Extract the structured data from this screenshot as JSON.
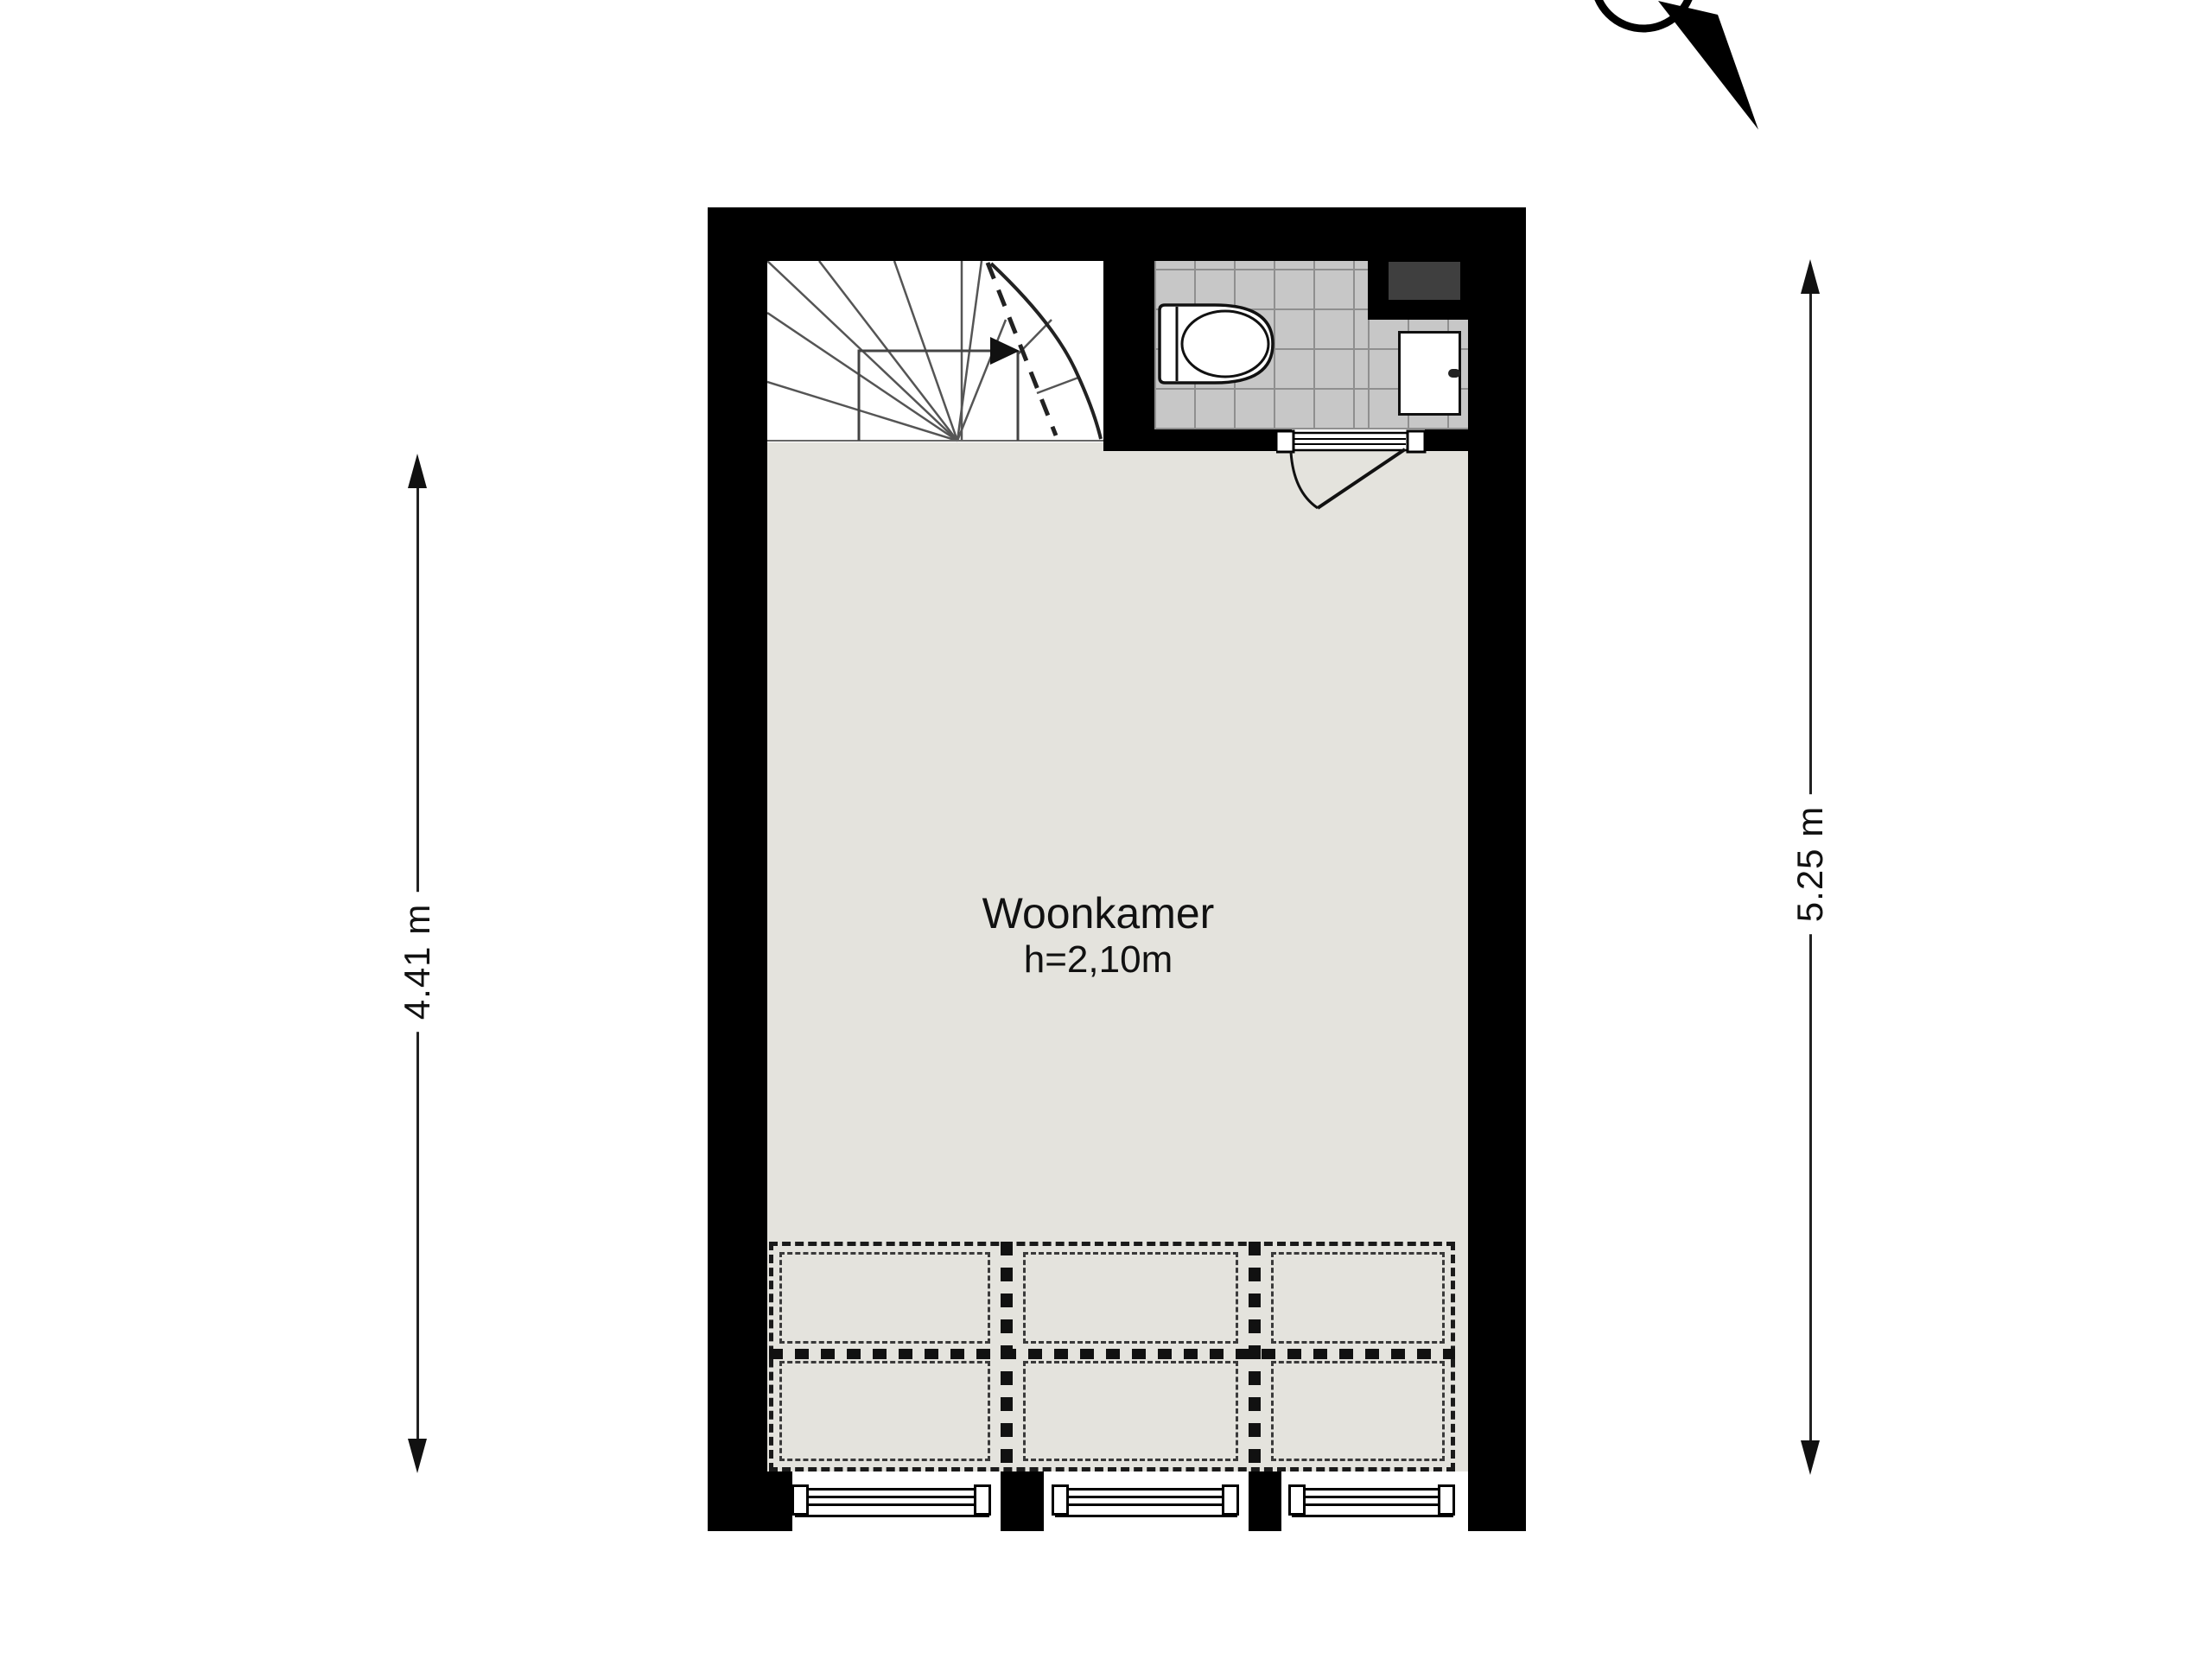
{
  "title": "floor-plan",
  "room": {
    "name": "Woonkamer",
    "height_note": "h=2,10m"
  },
  "dimensions": {
    "left_vertical": "4.41 m",
    "right_vertical": "5.25 m"
  },
  "icons": [
    "compass-needle-icon",
    "stair-winder-icon",
    "stair-direction-arrow-icon",
    "toilet-icon",
    "sink-icon",
    "faucet-icon",
    "door-swing-icon",
    "window-glazing-icon",
    "dimension-arrow-icon"
  ],
  "colors": {
    "wall": "#000000",
    "living_floor": "#e4e3dd",
    "tile_floor": "#c7c7c7",
    "tile_grout": "#8f8f8f",
    "shaft": "#3f3f3f",
    "dash_line": "#1a1a1a",
    "background": "#ffffff"
  }
}
